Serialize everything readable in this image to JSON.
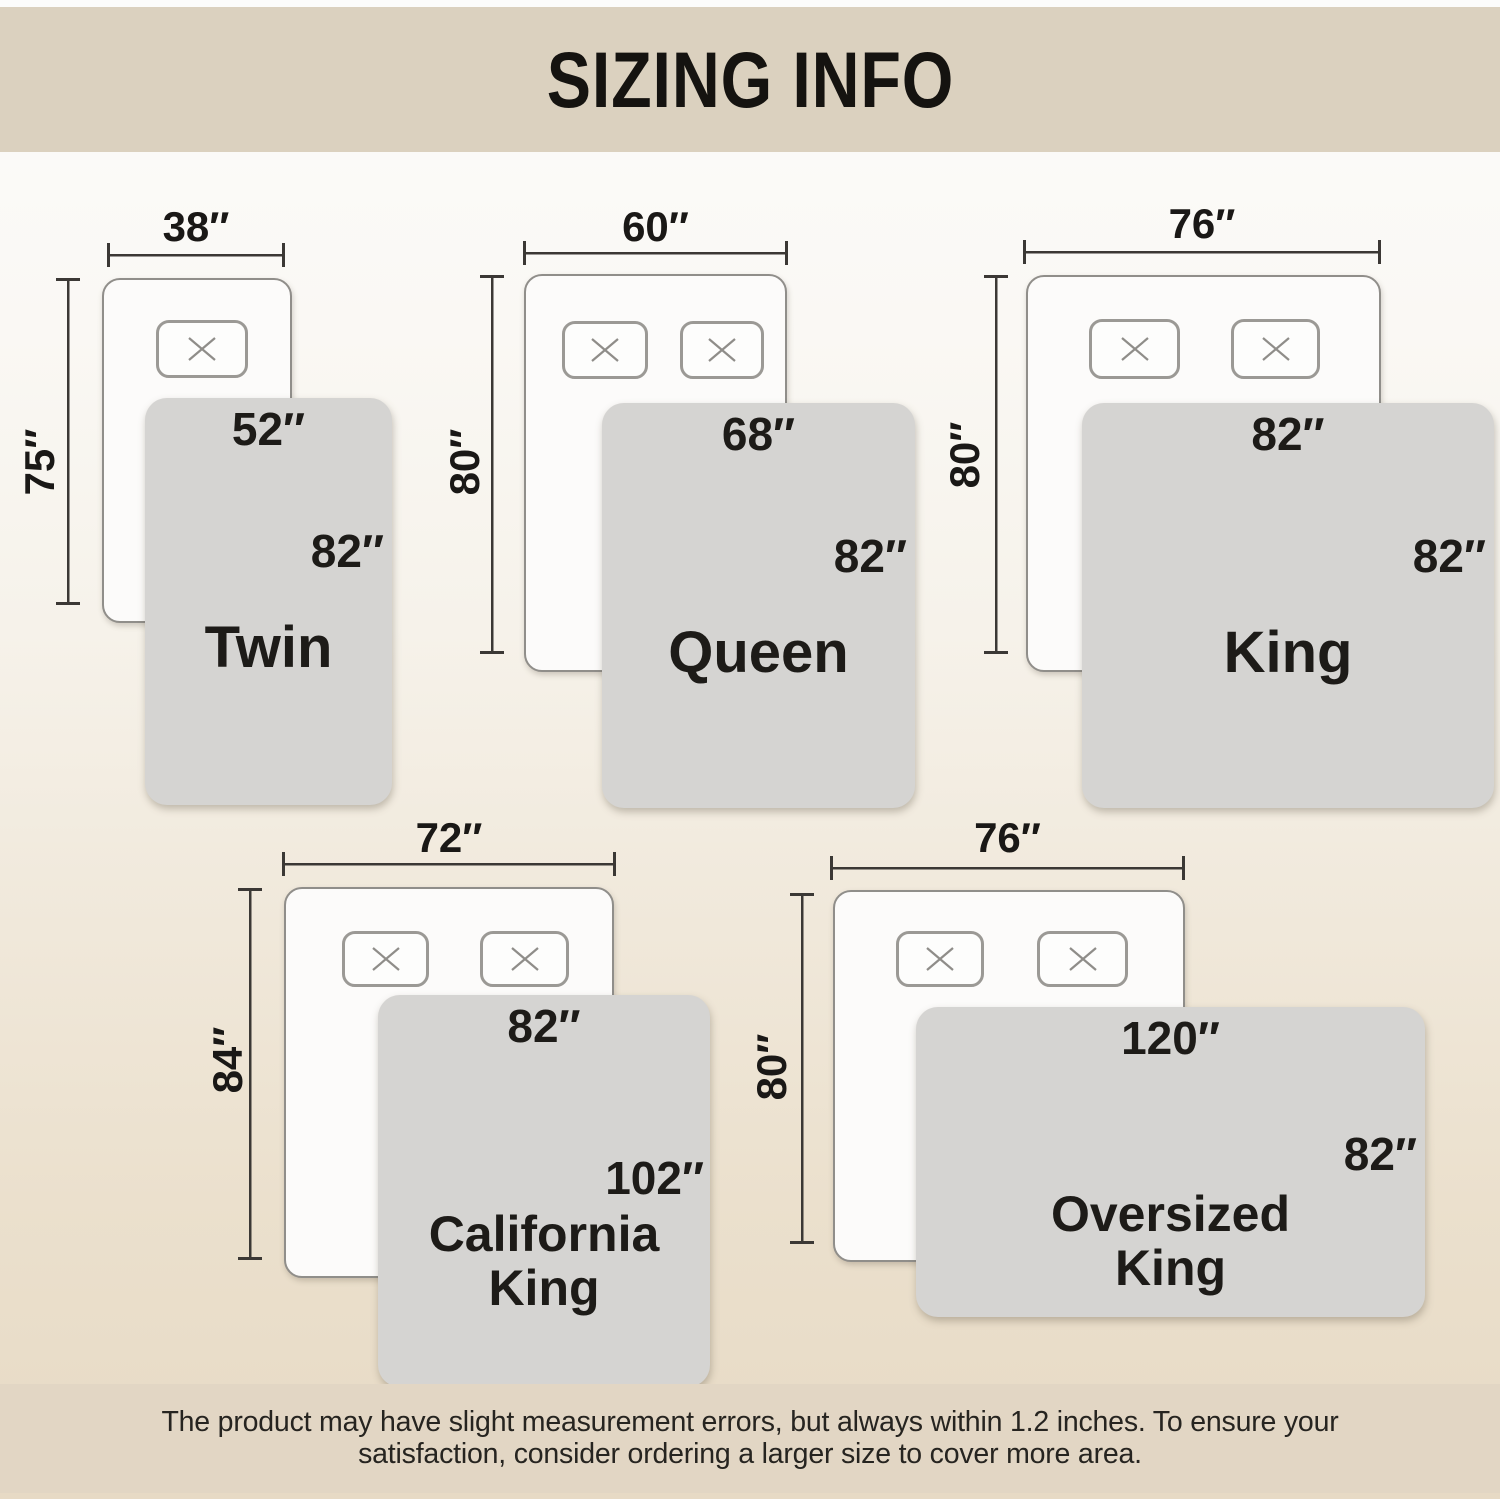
{
  "title": "SIZING INFO",
  "footer": {
    "lines": [
      "The product may have slight measurement errors, but always within 1.2 inches. To ensure your",
      "satisfaction, consider ordering a larger size to cover more area."
    ]
  },
  "colors": {
    "banner_bg": "#dbd1bf",
    "footer_bg": "#e2d6c4",
    "blanket_gray": "#d5d4d2",
    "mattress_white": "#fcfbfa",
    "line_dark": "#3b3835",
    "text_dark": "#1a1816"
  },
  "icons": {
    "pillow_cross": "pillow-x-icon"
  },
  "diagrams": [
    {
      "name": "Twin",
      "mattress_width": "38″",
      "mattress_length": "75″",
      "blanket_width": "52″",
      "blanket_length": "82″",
      "pillows": 1
    },
    {
      "name": "Queen",
      "mattress_width": "60″",
      "mattress_length": "80″",
      "blanket_width": "68″",
      "blanket_length": "82″",
      "pillows": 2
    },
    {
      "name": "King",
      "mattress_width": "76″",
      "mattress_length": "80″",
      "blanket_width": "82″",
      "blanket_length": "82″",
      "pillows": 2
    },
    {
      "name": "California King",
      "mattress_width": "72″",
      "mattress_length": "84″",
      "blanket_width": "82″",
      "blanket_length": "102″",
      "pillows": 2
    },
    {
      "name": "Oversized King",
      "mattress_width": "76″",
      "mattress_length": "80″",
      "blanket_width": "120″",
      "blanket_length": "82″",
      "pillows": 2
    }
  ]
}
